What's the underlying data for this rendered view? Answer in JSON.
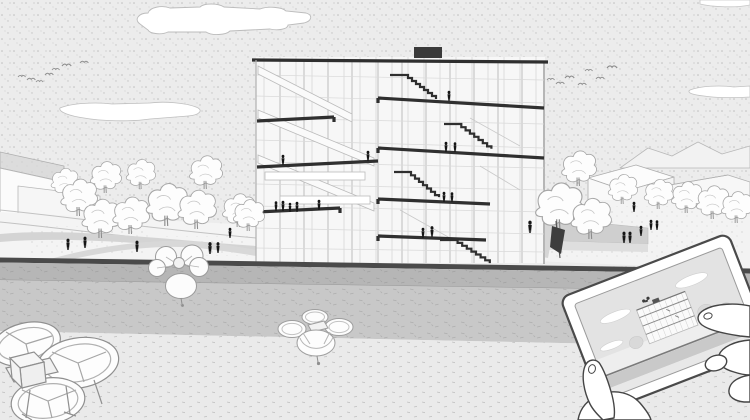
{
  "scene": {
    "title": "Monochrome architectural sectional-perspective illustration: mid-rise building with split-level stairs, plaza with trees and people, three drones, and two hands holding a tablet that displays a miniature of the same scene",
    "style": "black-and-white line drawing with stipple textures"
  },
  "colors": {
    "sky": "#ececec",
    "stipple_dot": "#bdbdbd",
    "cloud_fill": "#ffffff",
    "outline_gray": "#a6a6a6",
    "slab_dark": "#2f2f2f",
    "roof_box": "#3a3a3a",
    "curb_dark": "#4a4a4a",
    "road_upper": "#b6b6b6",
    "road_lower": "#c8c8c8",
    "foreground": "#eaeaea",
    "path_gray": "#d4d4d4",
    "walkway_gray": "#cfcfcf",
    "figure_black": "#161616",
    "flag_dark": "#3d3d3d",
    "tablet_line": "#4a4a4a",
    "screen_sky": "#e3e3e3",
    "screen_road": "#c9c9c9"
  },
  "inventory": {
    "building": {
      "kind": "section-cut mid-rise",
      "levels": 6,
      "dark_cut_slabs": 8,
      "visible_dark_stairs": 4,
      "rooftop_box": 1,
      "occupant_figures": 14
    },
    "bird_flocks": [
      {
        "side": "left",
        "count": 7
      },
      {
        "side": "right",
        "count": 7
      }
    ],
    "clouds": 4,
    "drones": [
      {
        "id": "large-foreground-drone",
        "position": "bottom-left"
      },
      {
        "id": "small-hovering-drone",
        "position": "center-bottom"
      },
      {
        "id": "top-view-flower-drone",
        "position": "left, over road"
      }
    ],
    "trees": {
      "left": 11,
      "right": 9
    },
    "plaza_people": {
      "left": 6,
      "right": 7
    },
    "flag_banner": 1,
    "low_buildings": {
      "left": 2,
      "right": 2
    },
    "tablet": {
      "held_by_hands": 2,
      "tilt_deg": -21,
      "screen_shows": "miniature of the same building scene with sky, clouds, trees, road band and a tiny drone"
    }
  }
}
